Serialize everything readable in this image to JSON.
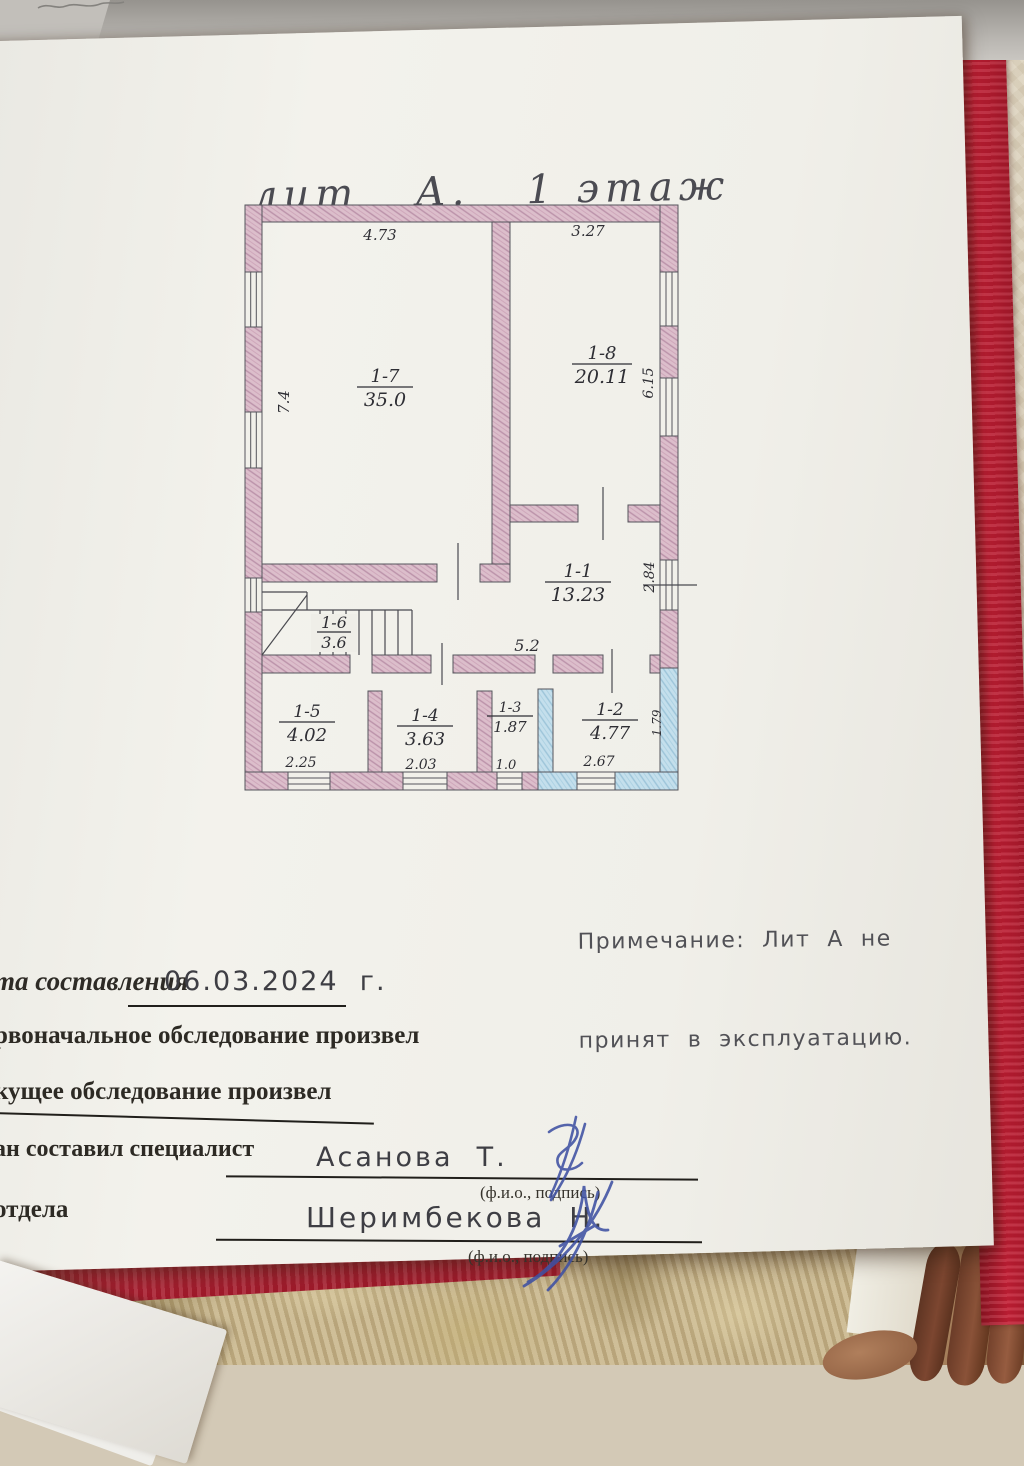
{
  "title": "лит   А.   1 этаж",
  "plan": {
    "rooms": [
      {
        "id": "1-7",
        "area": "35.0"
      },
      {
        "id": "1-8",
        "area": "20.11"
      },
      {
        "id": "1-1",
        "area": "13.23"
      },
      {
        "id": "1-6",
        "area": "3.6"
      },
      {
        "id": "1-5",
        "area": "4.02"
      },
      {
        "id": "1-4",
        "area": "3.63"
      },
      {
        "id": "1-3",
        "area": "1.87"
      },
      {
        "id": "1-2",
        "area": "4.77"
      }
    ],
    "dims": {
      "top_left": "4.73",
      "top_right": "3.27",
      "left": "7.4",
      "right_upper": "6.15",
      "right_mid": "2.84",
      "corridor": "5.2",
      "b1": "2.25",
      "b2": "2.03",
      "b3": "1.0",
      "b4": "2.67",
      "right_lower": "1.79"
    },
    "colors": {
      "wall_pink": "#dcbecb",
      "wall_blue": "#c4dfec",
      "line": "#55555c"
    }
  },
  "note": {
    "line1": "Примечание:  Лит  А  не",
    "line2": "принят  в  эксплуатацию."
  },
  "form": {
    "date_label": "та составления",
    "date_value": "06.03.2024  г.",
    "initial_survey": "рвоначальное обследование произвел",
    "current_survey": "кущее обследование произвел",
    "specialist_label": "ан составил специалист",
    "specialist_name": "Асанова  Т.",
    "fio_caption1": "(ф.и.о., подпись)",
    "department_label": "отдела",
    "department_name": "Шеримбекова  Н.",
    "fio_caption2": "(ф.и.о., подпись)"
  }
}
